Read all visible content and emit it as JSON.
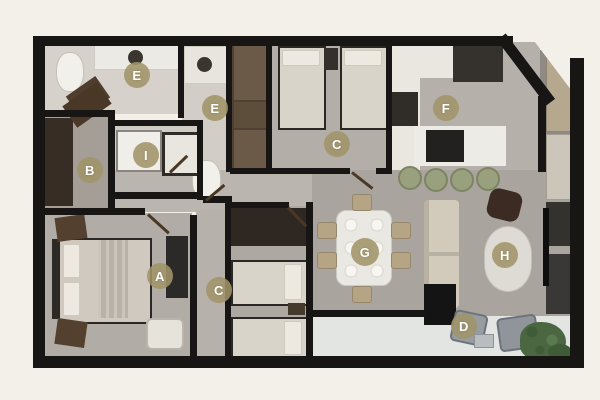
{
  "floorplan": {
    "markers": [
      {
        "letter": "E"
      },
      {
        "letter": "E"
      },
      {
        "letter": "B"
      },
      {
        "letter": "I"
      },
      {
        "letter": "C"
      },
      {
        "letter": "F"
      },
      {
        "letter": "A"
      },
      {
        "letter": "C"
      },
      {
        "letter": "G"
      },
      {
        "letter": "H"
      },
      {
        "letter": "D"
      }
    ],
    "colors": {
      "background": "#f3f0e9",
      "wall": "#171615",
      "marker_background": "#a09469",
      "marker_letter": "#ffffff",
      "concrete_floor": "#b3afa8",
      "bathroom_floor": "#d6d2cb",
      "terrace_floor": "#e2e5e2",
      "wood_dark": "#43372c",
      "counter_white": "#edebe5",
      "stool_olive": "#99a07d",
      "dining_chair_tan": "#b5a584",
      "sofa_beige": "#d2cbbc",
      "plant_green": "#4a6741",
      "dark_furniture": "#2c2a28"
    }
  }
}
